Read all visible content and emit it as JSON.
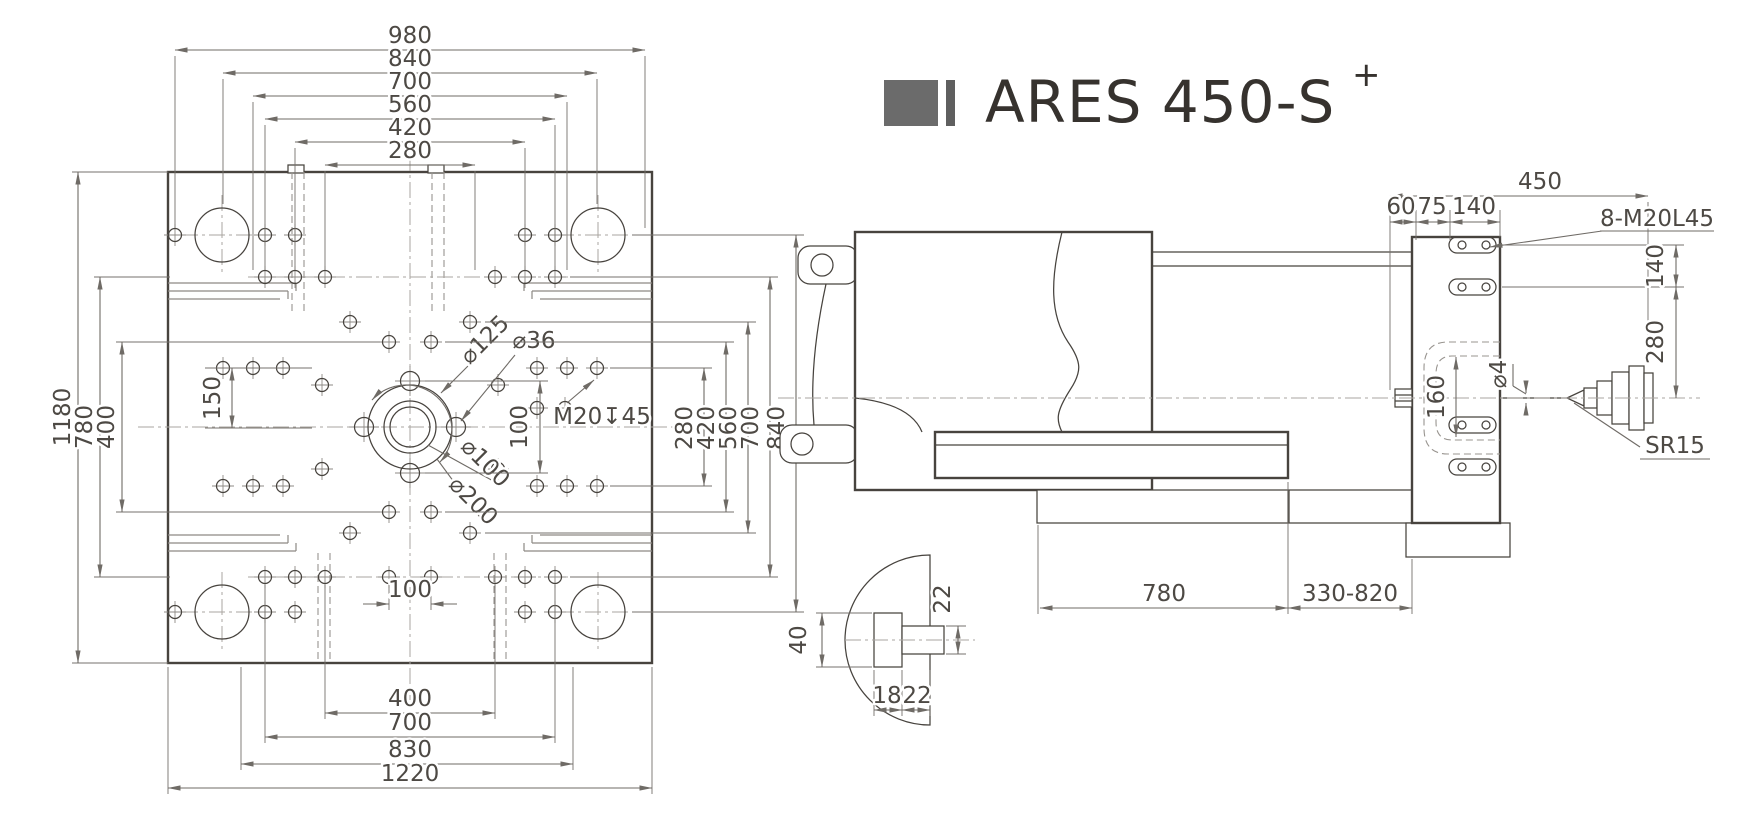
{
  "title": {
    "model": "ARES 450-S",
    "superscript": "+"
  },
  "left_view": {
    "top_dims": [
      "980",
      "840",
      "700",
      "560",
      "420",
      "280"
    ],
    "left_dims": [
      "1180",
      "780",
      "400"
    ],
    "left_inner_dim": "150",
    "right_dims": [
      "280",
      "420",
      "560",
      "700",
      "840"
    ],
    "bottom_inner_dim": "100",
    "bottom_dims": [
      "400",
      "700",
      "830",
      "1220"
    ],
    "center": {
      "bolt_circle": "⌀125",
      "pilot_hole": "⌀36",
      "tapped_hole": "M20↧45",
      "bore": "⌀100",
      "spigot": "⌀200",
      "pitch": "100"
    }
  },
  "side_view": {
    "width_dim": "450",
    "offset_dims": [
      "60",
      "75",
      "140"
    ],
    "tapped_holes_label": "8-M20L45",
    "right_dims": [
      "140",
      "280"
    ],
    "recess_dim": "160",
    "orifice_dim": "⌀4",
    "nozzle_label": "SR15",
    "bottom_dims": [
      "780",
      "330-820"
    ]
  },
  "detail_view": {
    "ring_height": "40",
    "channel_height": "22",
    "depth_dim": "18",
    "width_dim": "22"
  }
}
